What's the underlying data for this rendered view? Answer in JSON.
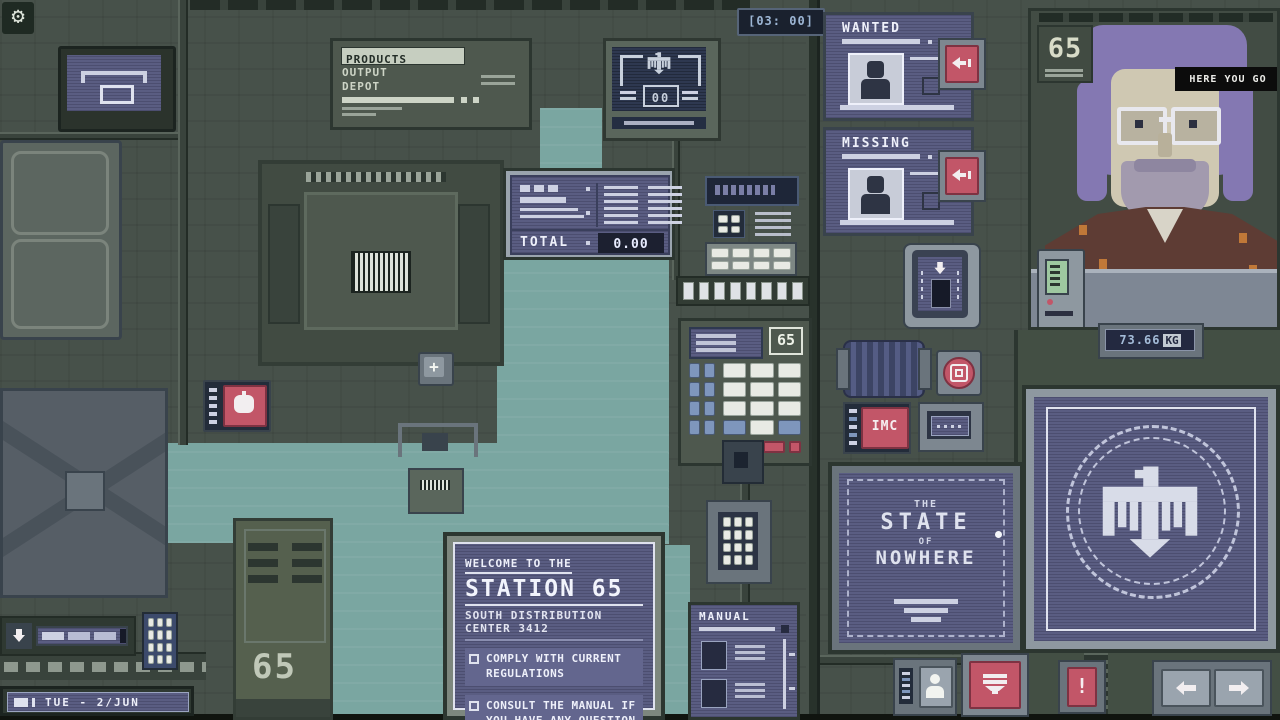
{
  "hud": {
    "clock_display": "[03: 00]",
    "date": "TUE - 2/JUN",
    "weight_value": "73.66",
    "weight_unit": "KG",
    "counter_value": "00",
    "speech_bubble": "HERE YOU GO",
    "booth_sign": "65"
  },
  "icons": {
    "plus": "+",
    "exclamation": "!",
    "gear": "⚙"
  },
  "products_panel": {
    "tab_label": "PRODUCTS",
    "line1": "OUTPUT",
    "line2": "DEPOT"
  },
  "total_display": {
    "label": "TOTAL",
    "value": "0.00"
  },
  "wanted_panel": {
    "title": "WANTED"
  },
  "missing_panel": {
    "title": "MISSING"
  },
  "keypad_panel": {
    "label": "65"
  },
  "imc_button": {
    "label": "IMC"
  },
  "state_panel": {
    "lines": [
      "THE",
      "STATE",
      "OF",
      "NOWHERE"
    ]
  },
  "welcome_panel": {
    "intro": "WELCOME TO THE",
    "title": "STATION 65",
    "subtitle1": "SOUTH DISTRIBUTION",
    "subtitle2": "CENTER 3412",
    "bullets": [
      "COMPLY WITH CURRENT REGULATIONS",
      "CONSULT THE MANUAL IF YOU HAVE ANY QUESTION"
    ]
  },
  "manual_panel": {
    "title": "MANUAL"
  },
  "locker": {
    "number": "65"
  }
}
